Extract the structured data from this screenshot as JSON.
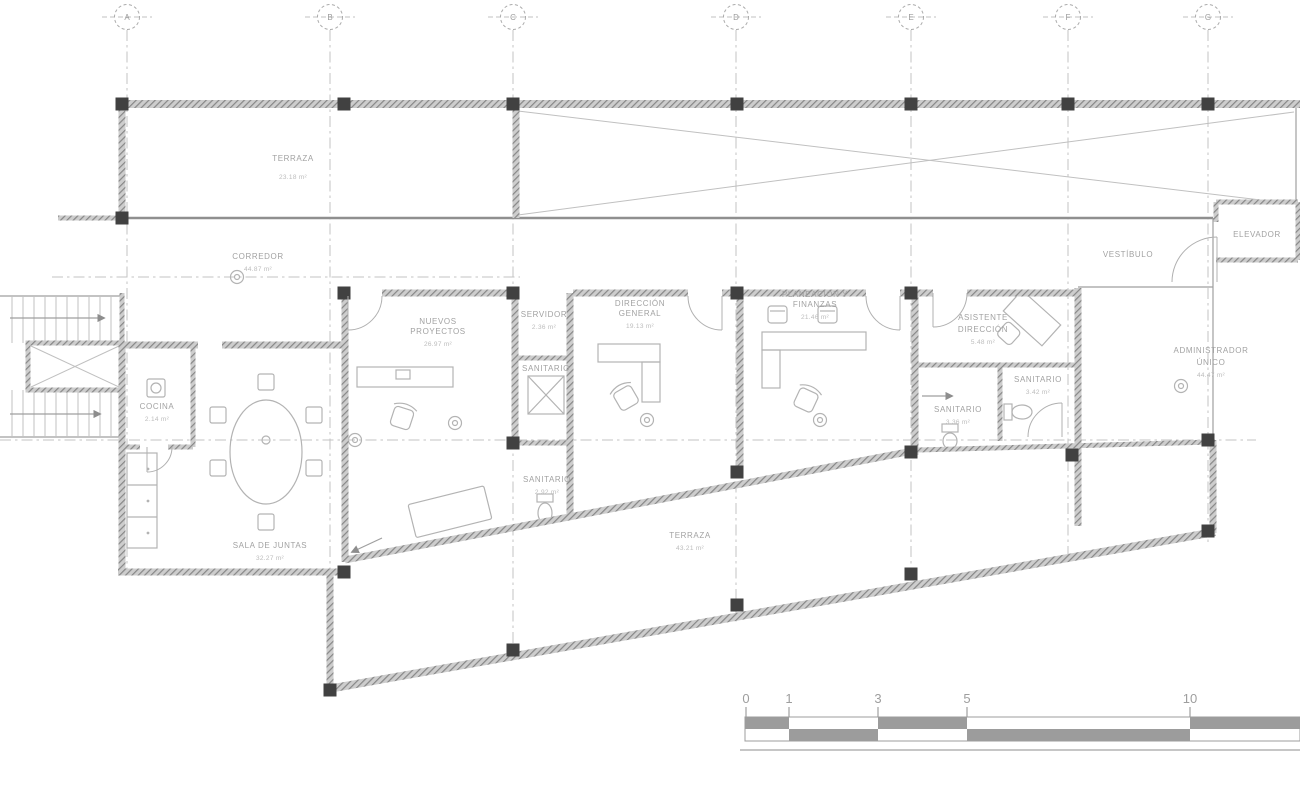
{
  "drawing_title": "Office floor plan",
  "colors": {
    "wall": "#8a8a8a",
    "line": "#9f9f9f",
    "text": "#a2a2a2",
    "column": "#414141",
    "scale_bar": "#9c9c9c"
  },
  "grid": {
    "cols": [
      "A",
      "B",
      "C",
      "D",
      "E",
      "F",
      "G"
    ]
  },
  "rooms": {
    "terraza_norte": {
      "name": "TERRAZA",
      "area": "23.18 m²"
    },
    "corredor": {
      "name": "CORREDOR",
      "area": "44.87 m²"
    },
    "vestibulo": {
      "name": "VESTÍBULO"
    },
    "elevador": {
      "name": "ELEVADOR"
    },
    "cocina": {
      "name": "COCINA",
      "area": "2.14 m²"
    },
    "sala_de_juntas": {
      "name": "SALA DE JUNTAS",
      "area": "32.27 m²"
    },
    "nuevos_proyectos": {
      "line1": "NUEVOS",
      "line2": "PROYECTOS",
      "area": "26.97 m²"
    },
    "servidor": {
      "name": "SERVIDOR",
      "area": "2.36 m²"
    },
    "sanitario_servidor": {
      "name": "SANITARIO"
    },
    "sanitario_centro": {
      "name": "SANITARIO",
      "area": "2.92 m²"
    },
    "direccion_general": {
      "line1": "DIRECCIÓN",
      "line2": "GENERAL",
      "area": "19.13 m²"
    },
    "planeacion_finanzas": {
      "line1": "PLANEACIÓN Y",
      "line2": "FINANZAS",
      "area": "21.46 m²"
    },
    "asistente_direccion": {
      "line1": "ASISTENTE",
      "line2": "DIRECCIÓN",
      "area": "5.48 m²"
    },
    "sanitario_oeste": {
      "name": "SANITARIO",
      "area": "3.36 m²"
    },
    "sanitario_este": {
      "name": "SANITARIO",
      "area": "3.42 m²"
    },
    "administrador_unico": {
      "line1": "ADMINISTRADOR",
      "line2": "ÚNICO",
      "area": "44.47 m²"
    },
    "terraza_sur": {
      "name": "TERRAZA",
      "area": "43.21 m²"
    }
  },
  "scale_bar": {
    "ticks": [
      "0",
      "1",
      "3",
      "5",
      "10"
    ]
  }
}
